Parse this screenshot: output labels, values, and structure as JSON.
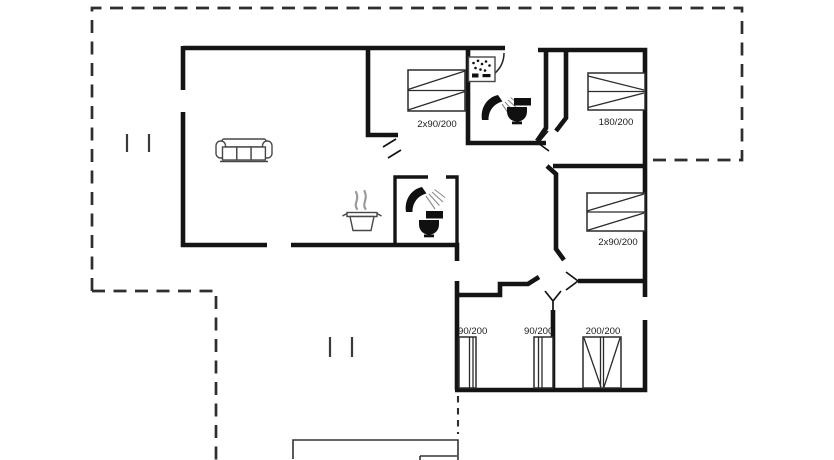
{
  "colors": {
    "background": "#ffffff",
    "wall": "#141414",
    "dashed_outline": "#2e2e2e",
    "furniture_stroke": "#474747",
    "icon_fill": "#101010",
    "label_text": "#1b1b1b"
  },
  "beds": [
    {
      "name": "bedroom-top-double-bed",
      "size": "2x90/200"
    },
    {
      "name": "bedroom-right-double-bed",
      "size": "180/200"
    },
    {
      "name": "bedroom-mid-double-bed",
      "size": "2x90/200"
    },
    {
      "name": "bottom-room-single-bed-left",
      "size": "90/200"
    },
    {
      "name": "bottom-room-single-bed-mid",
      "size": "90/200"
    },
    {
      "name": "bottom-room-double-bed",
      "size": "200/200"
    }
  ],
  "icons": [
    "sofa-icon",
    "steam-icon",
    "cooking-pot-icon",
    "washbasin-icon",
    "shower-icon",
    "toilet-icon",
    "door-swing-arc-icon",
    "door-swing-mark-icon",
    "window-mark-icon"
  ]
}
